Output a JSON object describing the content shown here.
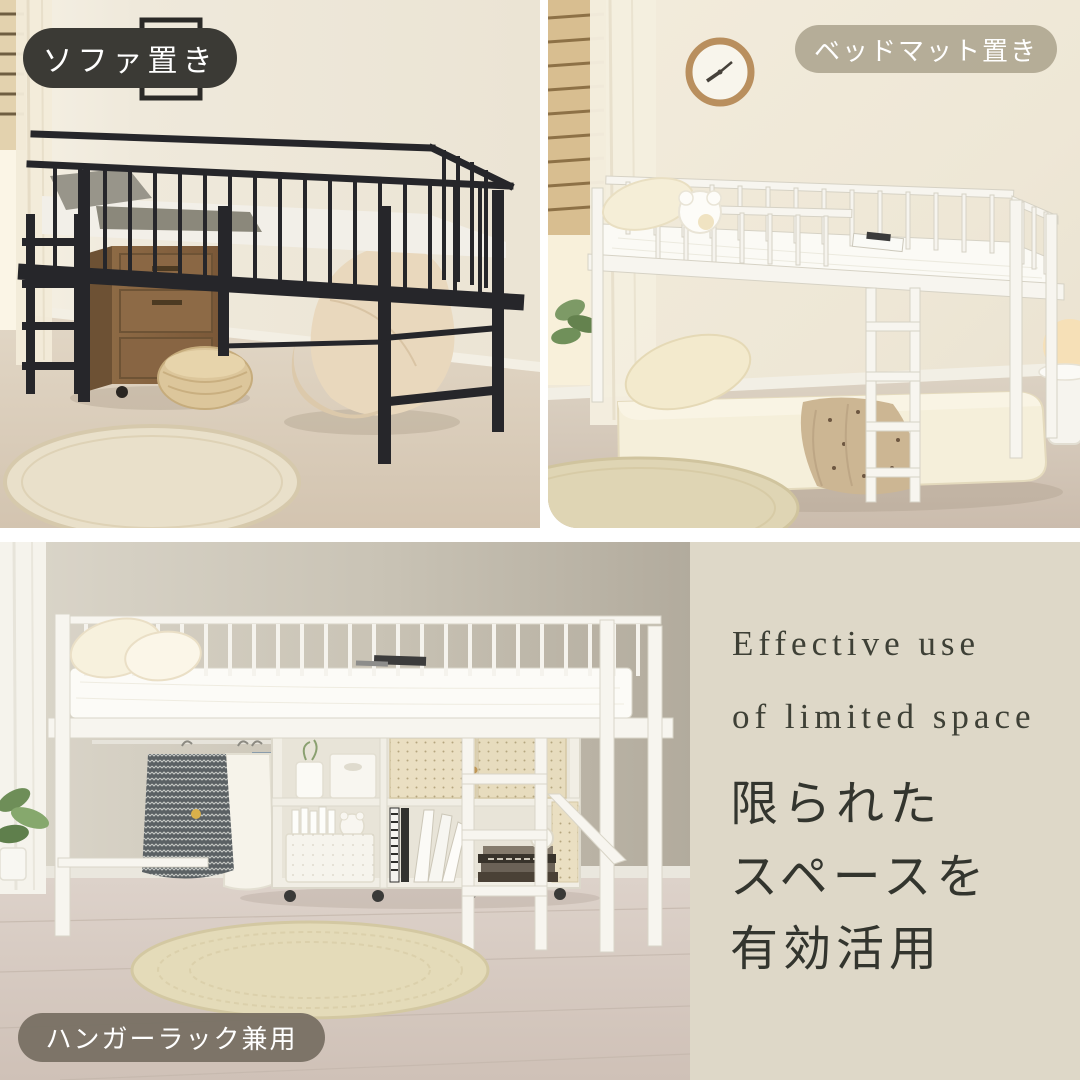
{
  "page": {
    "width": 1080,
    "height": 1080,
    "gap_color": "#ffffff"
  },
  "badges": {
    "sofa": {
      "label": "ソファ置き",
      "bg": "#3b3a35",
      "text_color": "#ffffff"
    },
    "bed_mat": {
      "label": "ベッドマット置き",
      "bg": "#b0a892",
      "text_color": "#ffffff"
    },
    "hanger_rack": {
      "label": "ハンガーラック兼用",
      "bg": "#787063",
      "text_color": "#ffffff"
    }
  },
  "text_panel": {
    "bg": "#ded8c8",
    "english_line1": "Effective use",
    "english_line2": "of limited space",
    "japanese_line1": "限られた",
    "japanese_line2": "スペースを",
    "japanese_line3": "有効活用",
    "text_color": "#3e4036"
  },
  "photos": {
    "top_left": {
      "subject": "black metal loft bed with cabinet, pouf and bean bag underneath"
    },
    "top_right": {
      "subject": "white loft bed with futon mattress placed underneath, wall clock"
    },
    "bottom": {
      "subject": "white loft bed used as hanger rack with shelf, clothes and round rug"
    }
  }
}
